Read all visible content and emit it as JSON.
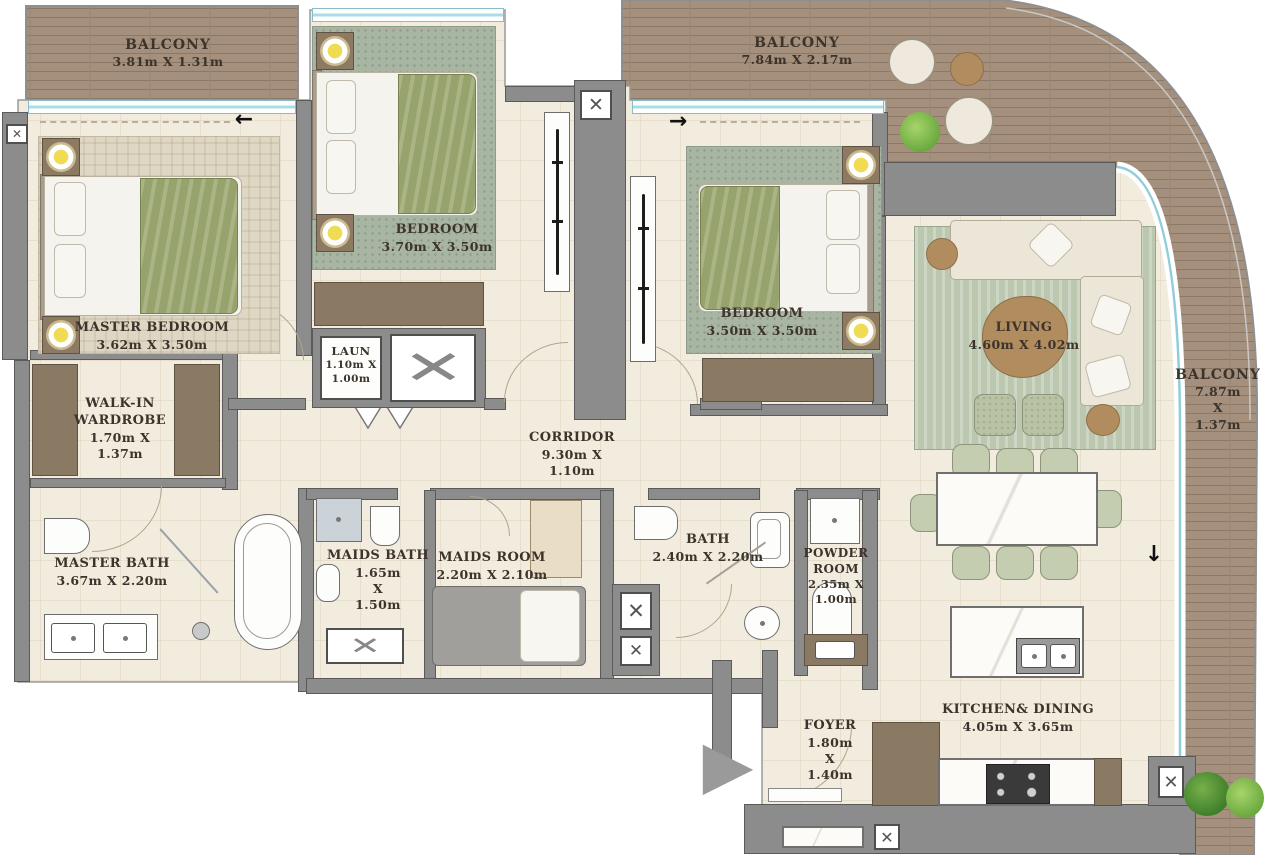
{
  "plan_type": "apartment-floor-plan",
  "rooms": [
    {
      "name": "BALCONY",
      "dims": "3.81m X 1.31m"
    },
    {
      "name": "BEDROOM",
      "dims": "3.70m X 3.50m"
    },
    {
      "name": "BALCONY",
      "dims": "7.84m X 2.17m"
    },
    {
      "name": "MASTER BEDROOM",
      "dims": "3.62m X 3.50m"
    },
    {
      "name": "WALK-IN WARDROBE",
      "dims": "1.70m X 1.37m"
    },
    {
      "name": "LAUN",
      "dims": "1.10m X 1.00m"
    },
    {
      "name": "CORRIDOR",
      "dims": "9.30m X 1.10m"
    },
    {
      "name": "BEDROOM",
      "dims": "3.50m X 3.50m"
    },
    {
      "name": "LIVING",
      "dims": "4.60m X 4.02m"
    },
    {
      "name": "BALCONY",
      "dims": "7.87m X 1.37m"
    },
    {
      "name": "MASTER BATH",
      "dims": "3.67m X 2.20m"
    },
    {
      "name": "MAIDS BATH",
      "dims": "1.65m X 1.50m"
    },
    {
      "name": "MAIDS ROOM",
      "dims": "2.20m X 2.10m"
    },
    {
      "name": "BATH",
      "dims": "2.40m X 2.20m"
    },
    {
      "name": "POWDER ROOM",
      "dims": "2.35m X 1.00m"
    },
    {
      "name": "KITCHEN& DINING",
      "dims": "4.05m X 3.65m"
    },
    {
      "name": "FOYER",
      "dims": "1.80m X 1.40m"
    }
  ],
  "icons": {
    "entry_arrow": "▶",
    "shaft_x": "✕",
    "arrow_left": "←",
    "arrow_right": "→",
    "arrow_down": "↓"
  },
  "colors": {
    "deck_wood": "#a4907d",
    "floor_tile": "#f2ecdf",
    "wall_gray": "#8c8c8c",
    "glass_teal": "#8fcddb",
    "label_text": "#3c332a",
    "bedding_green": "#97a36c",
    "rug_green": "#aab6a2",
    "wood_brown": "#8b7a63"
  }
}
